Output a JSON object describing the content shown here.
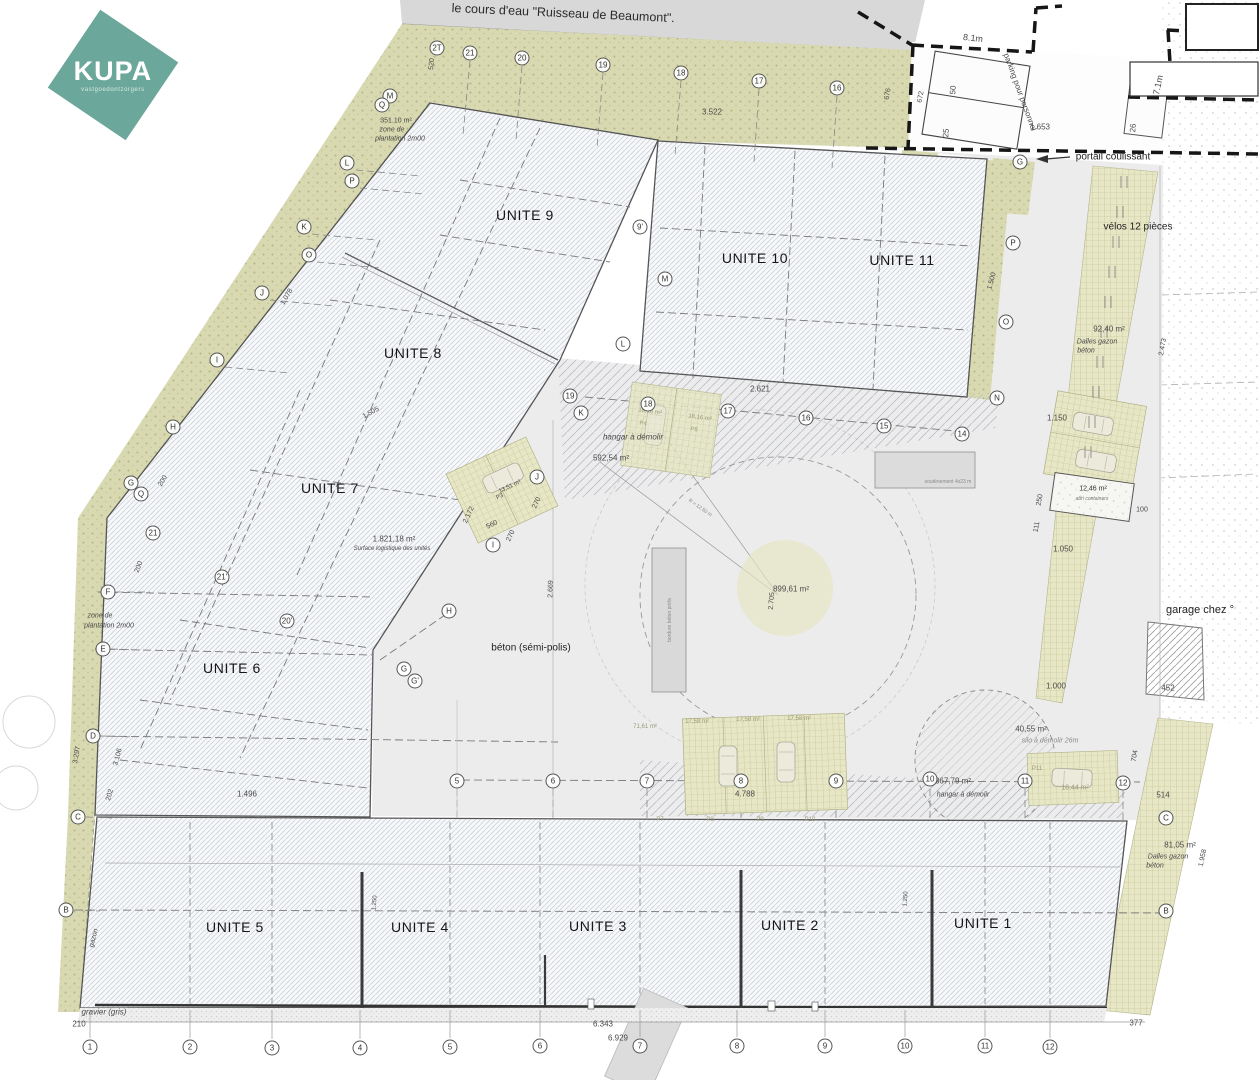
{
  "logo": {
    "brand": "KUPA",
    "tagline": "vastgoedontzorgers",
    "brand_color": "#6ba79a"
  },
  "colors": {
    "khaki_planting": "#d8d9b0",
    "khaki_grid": "#e7e7c6",
    "building_hatch": "#ccd1da",
    "yard_gray": "#ececec",
    "stream_gray": "#d8d8d8",
    "boundary_black": "#161616"
  },
  "plan": {
    "watercourse_label": "le cours d'eau \"Ruisseau de Beaumont\".",
    "units": [
      {
        "label": "UNITE 9",
        "x": 525,
        "y": 215
      },
      {
        "label": "UNITE 10",
        "x": 755,
        "y": 258
      },
      {
        "label": "UNITE 11",
        "x": 902,
        "y": 260
      },
      {
        "label": "UNITE 8",
        "x": 413,
        "y": 353
      },
      {
        "label": "UNITE 7",
        "x": 330,
        "y": 488
      },
      {
        "label": "UNITE 6",
        "x": 232,
        "y": 668
      },
      {
        "label": "UNITE 5",
        "x": 235,
        "y": 927
      },
      {
        "label": "UNITE 4",
        "x": 420,
        "y": 927
      },
      {
        "label": "UNITE 3",
        "x": 598,
        "y": 926
      },
      {
        "label": "UNITE 2",
        "x": 790,
        "y": 925
      },
      {
        "label": "UNITE 1",
        "x": 983,
        "y": 923
      }
    ],
    "annotations": [
      {
        "t": "351.10 m²",
        "x": 396,
        "y": 121,
        "s": 7
      },
      {
        "t": "zone de",
        "x": 392,
        "y": 130,
        "s": 7,
        "i": 1
      },
      {
        "t": "plantation 2m00",
        "x": 400,
        "y": 139,
        "s": 7,
        "i": 1
      },
      {
        "t": "520",
        "x": 432,
        "y": 64,
        "s": 7,
        "r": -85
      },
      {
        "t": "3.522",
        "x": 712,
        "y": 112,
        "s": 8
      },
      {
        "t": "676",
        "x": 888,
        "y": 94,
        "s": 7,
        "r": -80
      },
      {
        "t": "672",
        "x": 921,
        "y": 97,
        "s": 7,
        "r": -80
      },
      {
        "t": "8.1m",
        "x": 973,
        "y": 38,
        "s": 9,
        "r": 6
      },
      {
        "t": "parking pour personnel",
        "x": 1020,
        "y": 92,
        "s": 8,
        "r": 70
      },
      {
        "t": "50",
        "x": 953,
        "y": 90,
        "s": 8,
        "r": -85
      },
      {
        "t": "25",
        "x": 946,
        "y": 133,
        "s": 8,
        "r": -85
      },
      {
        "t": "26",
        "x": 1133,
        "y": 128,
        "s": 8,
        "r": -85
      },
      {
        "t": "1.653",
        "x": 1040,
        "y": 127,
        "s": 8
      },
      {
        "t": "7.1m",
        "x": 1158,
        "y": 85,
        "s": 9,
        "r": -78
      },
      {
        "t": "portail coulissant",
        "x": 1113,
        "y": 157,
        "s": 10,
        "c": "#222222"
      },
      {
        "t": "vélos 12 pièces",
        "x": 1138,
        "y": 227,
        "s": 10,
        "c": "#222222"
      },
      {
        "t": "92,40 m²",
        "x": 1109,
        "y": 329,
        "s": 8
      },
      {
        "t": "Dalles gazon",
        "x": 1097,
        "y": 342,
        "s": 7,
        "i": 1
      },
      {
        "t": "béton",
        "x": 1086,
        "y": 351,
        "s": 7,
        "i": 1
      },
      {
        "t": "2.473",
        "x": 1163,
        "y": 347,
        "s": 7,
        "r": -80
      },
      {
        "t": "1.500",
        "x": 992,
        "y": 281,
        "s": 7,
        "r": -75
      },
      {
        "t": "2.621",
        "x": 760,
        "y": 389,
        "s": 8
      },
      {
        "t": "1.150",
        "x": 1057,
        "y": 418,
        "s": 8
      },
      {
        "t": "hangar à démolir",
        "x": 633,
        "y": 437,
        "s": 8,
        "i": 1
      },
      {
        "t": "592,54 m²",
        "x": 611,
        "y": 458,
        "s": 8
      },
      {
        "t": "18,16 m²",
        "x": 650,
        "y": 412,
        "s": 6,
        "r": 8,
        "c": "#9a9a7a"
      },
      {
        "t": "18,16 m²",
        "x": 700,
        "y": 418,
        "s": 6,
        "r": 8,
        "c": "#9a9a7a"
      },
      {
        "t": "P4",
        "x": 643,
        "y": 424,
        "s": 6,
        "r": 8,
        "c": "#9a9a7a"
      },
      {
        "t": "P5",
        "x": 694,
        "y": 430,
        "s": 6,
        "r": 8,
        "c": "#9a9a7a"
      },
      {
        "t": "13,51 m²",
        "x": 510,
        "y": 487,
        "s": 6,
        "r": -25
      },
      {
        "t": "P3",
        "x": 500,
        "y": 497,
        "s": 6,
        "r": -25
      },
      {
        "t": "2.172",
        "x": 469,
        "y": 515,
        "s": 7,
        "r": -65
      },
      {
        "t": "560",
        "x": 492,
        "y": 525,
        "s": 7,
        "r": -25
      },
      {
        "t": "270",
        "x": 537,
        "y": 503,
        "s": 7,
        "r": -65
      },
      {
        "t": "270",
        "x": 511,
        "y": 536,
        "s": 7,
        "r": -65
      },
      {
        "t": "1.505",
        "x": 371,
        "y": 413,
        "s": 7,
        "r": -28
      },
      {
        "t": "1.078",
        "x": 287,
        "y": 297,
        "s": 7,
        "r": -60
      },
      {
        "t": "1.821,18 m²",
        "x": 394,
        "y": 539,
        "s": 8
      },
      {
        "t": "Surface logistique des unités",
        "x": 392,
        "y": 549,
        "s": 6,
        "i": 1
      },
      {
        "t": "200",
        "x": 163,
        "y": 481,
        "s": 7,
        "r": -60
      },
      {
        "t": "200",
        "x": 139,
        "y": 567,
        "s": 7,
        "r": -70
      },
      {
        "t": "zone de",
        "x": 100,
        "y": 616,
        "s": 7,
        "i": 1
      },
      {
        "t": "plantation 2m00",
        "x": 109,
        "y": 626,
        "s": 7,
        "i": 1
      },
      {
        "t": "3.297",
        "x": 77,
        "y": 755,
        "s": 7,
        "r": -80
      },
      {
        "t": "3.106",
        "x": 118,
        "y": 757,
        "s": 7,
        "r": -75
      },
      {
        "t": "202",
        "x": 110,
        "y": 795,
        "s": 7,
        "r": -75
      },
      {
        "t": "1.496",
        "x": 247,
        "y": 794,
        "s": 8
      },
      {
        "t": "béton (sémi-polis)",
        "x": 531,
        "y": 648,
        "s": 10,
        "c": "#222222"
      },
      {
        "t": "2.669",
        "x": 551,
        "y": 589,
        "s": 7,
        "r": -88
      },
      {
        "t": "899,61 m²",
        "x": 791,
        "y": 589,
        "s": 8
      },
      {
        "t": "2.705",
        "x": 772,
        "y": 601,
        "s": 7,
        "r": -85
      },
      {
        "t": "71,61 m²",
        "x": 645,
        "y": 727,
        "s": 6,
        "c": "#9a9a7a"
      },
      {
        "t": "17,58 m²",
        "x": 697,
        "y": 722,
        "s": 6,
        "c": "#9a9a7a"
      },
      {
        "t": "17,58 m²",
        "x": 748,
        "y": 720,
        "s": 6,
        "c": "#9a9a7a"
      },
      {
        "t": "17,58 m²",
        "x": 799,
        "y": 719,
        "s": 6,
        "c": "#9a9a7a"
      },
      {
        "t": "4.788",
        "x": 745,
        "y": 794,
        "s": 8
      },
      {
        "t": "P7",
        "x": 660,
        "y": 820,
        "s": 6,
        "c": "#9a9a7a"
      },
      {
        "t": "P8",
        "x": 710,
        "y": 820,
        "s": 6,
        "c": "#9a9a7a"
      },
      {
        "t": "P9",
        "x": 760,
        "y": 820,
        "s": 6,
        "c": "#9a9a7a"
      },
      {
        "t": "P10",
        "x": 810,
        "y": 820,
        "s": 6,
        "c": "#9a9a7a"
      },
      {
        "t": "40,55 m²",
        "x": 1031,
        "y": 729,
        "s": 8
      },
      {
        "t": "silo à démolir 26m",
        "x": 1050,
        "y": 741,
        "s": 7,
        "i": 1,
        "c": "#8a8a8a"
      },
      {
        "t": "367,79 m²",
        "x": 953,
        "y": 781,
        "s": 8
      },
      {
        "t": "hangar à démolir",
        "x": 963,
        "y": 795,
        "s": 7,
        "i": 1
      },
      {
        "t": "18,44 m²",
        "x": 1075,
        "y": 788,
        "s": 7,
        "c": "#9a9a7a"
      },
      {
        "t": "P11",
        "x": 1037,
        "y": 769,
        "s": 6,
        "c": "#9a9a7a"
      },
      {
        "t": "12,46 m²",
        "x": 1093,
        "y": 489,
        "s": 7,
        "c": "#333333"
      },
      {
        "t": "abri containers",
        "x": 1092,
        "y": 499,
        "s": 5,
        "i": 1,
        "c": "#777777"
      },
      {
        "t": "100",
        "x": 1142,
        "y": 510,
        "s": 7
      },
      {
        "t": "250",
        "x": 1040,
        "y": 500,
        "s": 7,
        "r": -80
      },
      {
        "t": "111",
        "x": 1037,
        "y": 527,
        "s": 7,
        "r": -80
      },
      {
        "t": "1.050",
        "x": 1063,
        "y": 549,
        "s": 8
      },
      {
        "t": "garage chez °",
        "x": 1200,
        "y": 610,
        "s": 11,
        "c": "#222222"
      },
      {
        "t": "1.000",
        "x": 1056,
        "y": 686,
        "s": 8
      },
      {
        "t": "452",
        "x": 1168,
        "y": 688,
        "s": 8
      },
      {
        "t": "704",
        "x": 1135,
        "y": 756,
        "s": 7,
        "r": -80
      },
      {
        "t": "514",
        "x": 1163,
        "y": 795,
        "s": 8
      },
      {
        "t": "81,05 m²",
        "x": 1180,
        "y": 845,
        "s": 8
      },
      {
        "t": "Dalles gazon",
        "x": 1168,
        "y": 857,
        "s": 7,
        "i": 1
      },
      {
        "t": "béton",
        "x": 1155,
        "y": 866,
        "s": 7,
        "i": 1
      },
      {
        "t": "1.958",
        "x": 1203,
        "y": 858,
        "s": 7,
        "r": -78
      },
      {
        "t": "377",
        "x": 1136,
        "y": 1023,
        "s": 8
      },
      {
        "t": "gazon",
        "x": 94,
        "y": 938,
        "s": 7,
        "r": -75,
        "i": 1
      },
      {
        "t": "gravier (gris)",
        "x": 104,
        "y": 1012,
        "s": 8,
        "i": 1
      },
      {
        "t": "210",
        "x": 79,
        "y": 1024,
        "s": 8
      },
      {
        "t": "6.343",
        "x": 603,
        "y": 1024,
        "s": 8
      },
      {
        "t": "6.929",
        "x": 618,
        "y": 1038,
        "s": 8
      },
      {
        "t": "1.250",
        "x": 375,
        "y": 903,
        "s": 6,
        "r": -85
      },
      {
        "t": "1.250",
        "x": 906,
        "y": 899,
        "s": 6,
        "r": -85
      },
      {
        "t": "soutènement 4x23 m",
        "x": 948,
        "y": 482,
        "s": 5,
        "c": "#8a8a8a"
      },
      {
        "t": "bordure béton préfa",
        "x": 670,
        "y": 620,
        "s": 5,
        "r": -90,
        "c": "#8a8a8a"
      },
      {
        "t": "R = 12,50 m",
        "x": 700,
        "y": 508,
        "s": 5,
        "r": 35,
        "c": "#8a8a8a"
      }
    ],
    "bubbles": [
      {
        "t": "2T",
        "x": 437,
        "y": 48
      },
      {
        "t": "21",
        "x": 470,
        "y": 53
      },
      {
        "t": "20",
        "x": 522,
        "y": 58
      },
      {
        "t": "19",
        "x": 603,
        "y": 65
      },
      {
        "t": "18",
        "x": 681,
        "y": 73
      },
      {
        "t": "17",
        "x": 759,
        "y": 81
      },
      {
        "t": "16",
        "x": 837,
        "y": 88
      },
      {
        "t": "19",
        "x": 570,
        "y": 396
      },
      {
        "t": "K",
        "x": 581,
        "y": 413
      },
      {
        "t": "18",
        "x": 648,
        "y": 404
      },
      {
        "t": "17",
        "x": 728,
        "y": 411
      },
      {
        "t": "16",
        "x": 806,
        "y": 418
      },
      {
        "t": "15",
        "x": 884,
        "y": 426
      },
      {
        "t": "14",
        "x": 962,
        "y": 434
      },
      {
        "t": "M",
        "x": 390,
        "y": 96
      },
      {
        "t": "Q",
        "x": 382,
        "y": 105
      },
      {
        "t": "L",
        "x": 347,
        "y": 163
      },
      {
        "t": "P",
        "x": 352,
        "y": 181
      },
      {
        "t": "K",
        "x": 304,
        "y": 227
      },
      {
        "t": "O",
        "x": 309,
        "y": 255
      },
      {
        "t": "J",
        "x": 262,
        "y": 293
      },
      {
        "t": "I",
        "x": 217,
        "y": 360
      },
      {
        "t": "H",
        "x": 173,
        "y": 427
      },
      {
        "t": "G",
        "x": 131,
        "y": 483
      },
      {
        "t": "Q",
        "x": 141,
        "y": 494
      },
      {
        "t": "21",
        "x": 153,
        "y": 533
      },
      {
        "t": "F",
        "x": 108,
        "y": 592
      },
      {
        "t": "E",
        "x": 103,
        "y": 649
      },
      {
        "t": "D",
        "x": 93,
        "y": 736
      },
      {
        "t": "C",
        "x": 78,
        "y": 817
      },
      {
        "t": "B",
        "x": 66,
        "y": 910
      },
      {
        "t": "21'",
        "x": 222,
        "y": 577
      },
      {
        "t": "20'",
        "x": 287,
        "y": 621
      },
      {
        "t": "H",
        "x": 449,
        "y": 611
      },
      {
        "t": "G",
        "x": 404,
        "y": 669
      },
      {
        "t": "G'",
        "x": 415,
        "y": 681
      },
      {
        "t": "9'",
        "x": 640,
        "y": 227
      },
      {
        "t": "M",
        "x": 665,
        "y": 279
      },
      {
        "t": "L",
        "x": 623,
        "y": 344
      },
      {
        "t": "J",
        "x": 537,
        "y": 477
      },
      {
        "t": "I",
        "x": 493,
        "y": 545
      },
      {
        "t": "P",
        "x": 1013,
        "y": 243
      },
      {
        "t": "O",
        "x": 1006,
        "y": 322
      },
      {
        "t": "N",
        "x": 997,
        "y": 398
      },
      {
        "t": "G",
        "x": 1020,
        "y": 162
      },
      {
        "t": "5",
        "x": 457,
        "y": 781
      },
      {
        "t": "6",
        "x": 553,
        "y": 781
      },
      {
        "t": "7",
        "x": 647,
        "y": 781
      },
      {
        "t": "8",
        "x": 741,
        "y": 781
      },
      {
        "t": "9",
        "x": 836,
        "y": 781
      },
      {
        "t": "10",
        "x": 930,
        "y": 779
      },
      {
        "t": "11",
        "x": 1025,
        "y": 781
      },
      {
        "t": "12",
        "x": 1123,
        "y": 783
      },
      {
        "t": "C",
        "x": 1166,
        "y": 818
      },
      {
        "t": "B",
        "x": 1166,
        "y": 911
      },
      {
        "t": "1",
        "x": 90,
        "y": 1047
      },
      {
        "t": "2",
        "x": 190,
        "y": 1047
      },
      {
        "t": "3",
        "x": 272,
        "y": 1048
      },
      {
        "t": "4",
        "x": 360,
        "y": 1048
      },
      {
        "t": "5",
        "x": 450,
        "y": 1047
      },
      {
        "t": "6",
        "x": 540,
        "y": 1046
      },
      {
        "t": "7",
        "x": 640,
        "y": 1046
      },
      {
        "t": "8",
        "x": 737,
        "y": 1046
      },
      {
        "t": "9",
        "x": 825,
        "y": 1046
      },
      {
        "t": "10",
        "x": 905,
        "y": 1046
      },
      {
        "t": "11",
        "x": 985,
        "y": 1046
      },
      {
        "t": "12",
        "x": 1050,
        "y": 1047
      }
    ]
  }
}
